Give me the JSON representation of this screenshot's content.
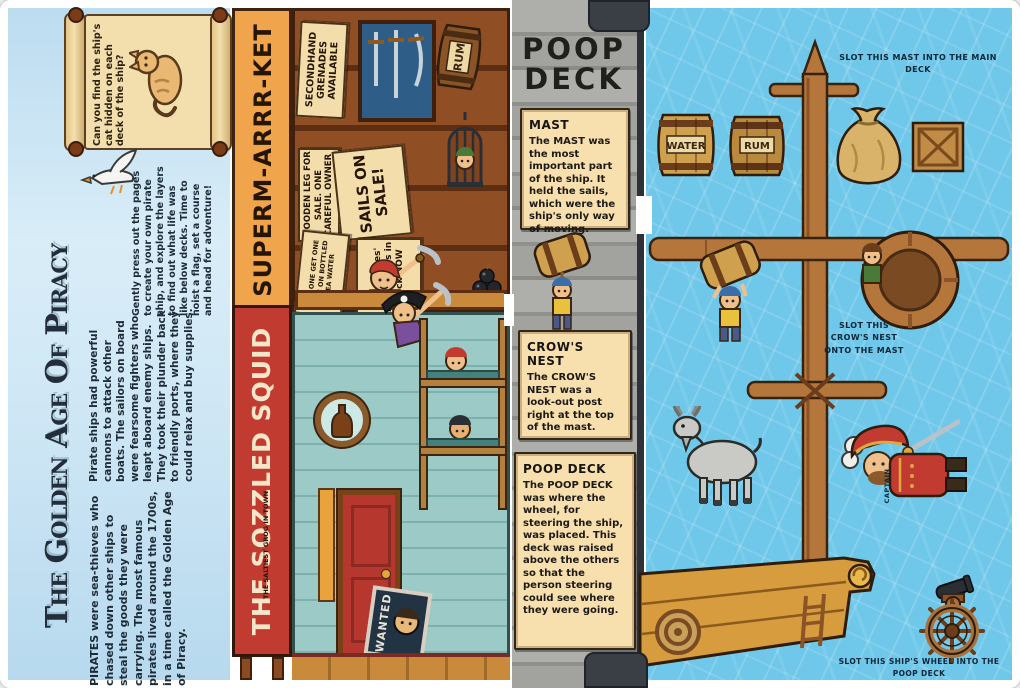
{
  "book": {
    "intro": {
      "title": "The Golden Age Of Piracy",
      "scroll_question": "Can you find the ship's cat hidden on each deck of the ship?",
      "para_pirates": "PIRATES were sea-thieves who chased down other ships to steal the goods they were carrying. The most famous pirates lived around the 1700s, in a time called the Golden Age of Piracy.",
      "para_ships": "Pirate ships had powerful cannons to attack other boats. The sailors on board were fearsome fighters who leapt aboard enemy ships. They took their plunder back to friendly ports, where they could relax and buy supplies.",
      "para_pressout": "Gently press out the pages to create your own pirate ship, and explore the layers to find out what life was like below decks. Time to hoist a flag, set a course and head for adventure!"
    },
    "supermarket": {
      "name": "SUPERM-ARRR-KET",
      "sign_grenades": "SECONDHAND GRENADES AVAILABLE",
      "sign_wooden_leg": "WOODEN LEG FOR SALE. ONE CAREFUL OWNER",
      "sign_sails": "SAILS ON SALE!",
      "sign_bogo": "BUY ONE GET ONE FREE ON BOTTLED SEA WATER",
      "sign_kegs": "Davy Jones' locker kegs in stock NOW",
      "barrel_label": "RUM"
    },
    "tavern": {
      "name": "THE SOZZLED SQUID",
      "sign_grog": "THE SALTIEST GROG IN TOWN",
      "poster": "WANTED"
    },
    "deck_sheet": {
      "title": "POOP DECK",
      "notes": [
        {
          "heading": "MAST",
          "body": "The MAST was the most important part of the ship. It held the sails, which were the ship's only way of moving."
        },
        {
          "heading": "CROW'S NEST",
          "body": "The CROW'S NEST was a look-out post right at the top of the mast."
        },
        {
          "heading": "POOP DECK",
          "body": "The POOP DECK was where the wheel, for steering the ship, was placed. This deck was raised above the others so that the person steering could see where they were going."
        }
      ]
    },
    "pressouts": {
      "label_mast": "SLOT THIS MAST INTO THE MAIN DECK",
      "label_crows_nest": "SLOT THIS CROW'S NEST ONTO THE MAST",
      "label_wheel": "SLOT THIS SHIP'S WHEEL INTO THE POOP DECK",
      "label_captain": "CAPTAIN",
      "barrel_water": "WATER",
      "barrel_rum": "RUM"
    },
    "colors": {
      "water": "#6fc7e9",
      "sky": "#cfe7f5",
      "supermarket_sign": "#f0a44c",
      "tavern_sign": "#c23b30",
      "parchment": "#f6deab",
      "deck_gray": "#a4a4a0",
      "wood": "#b5763c"
    }
  }
}
